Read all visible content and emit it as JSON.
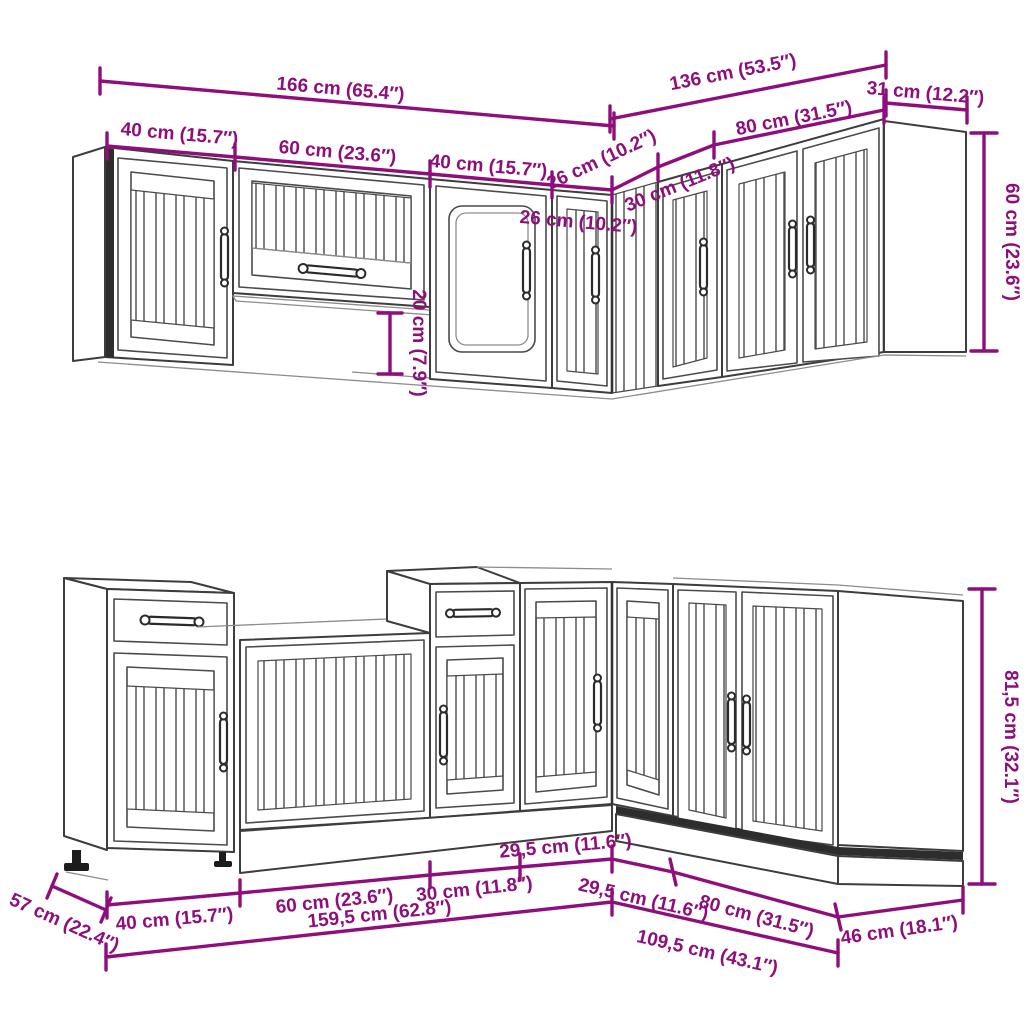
{
  "title": "Kitchen cabinet set — dimensional line diagram",
  "colors": {
    "dimension_accent": "#8e0e7c",
    "outline": "#3d3d3d",
    "background": "#ffffff"
  },
  "dimensions": {
    "upper": {
      "total_left": "166 cm (65.4″)",
      "total_right": "136 cm (53.5″)",
      "side_depth": "31 cm (12.2″)",
      "cab_40_a": "40 cm (15.7″)",
      "cab_60": "60 cm (23.6″)",
      "cab_40_b": "40 cm (15.7″)",
      "cab_26_left": "26 cm (10.2″)",
      "cab_26_right": "26 cm (10.2″)",
      "cab_30": "30 cm (11.8″)",
      "cab_80": "80 cm (31.5″)",
      "height": "60 cm (23.6″)",
      "height_offset": "20 cm (7.9″)"
    },
    "lower": {
      "cab_40": "40 cm (15.7″)",
      "cab_60": "60 cm (23.6″)",
      "cab_30": "30 cm (11.8″)",
      "corner_left": "29,5 cm (11.6″)",
      "corner_right": "29,5 cm (11.6″)",
      "cab_80": "80 cm (31.5″)",
      "side_depth": "46 cm (18.1″)",
      "run_left_total": "159,5 cm (62.8″)",
      "run_right_total": "109,5 cm (43.1″)",
      "height": "81,5 cm (32.1″)",
      "depth": "57 cm (22.4″)"
    }
  }
}
